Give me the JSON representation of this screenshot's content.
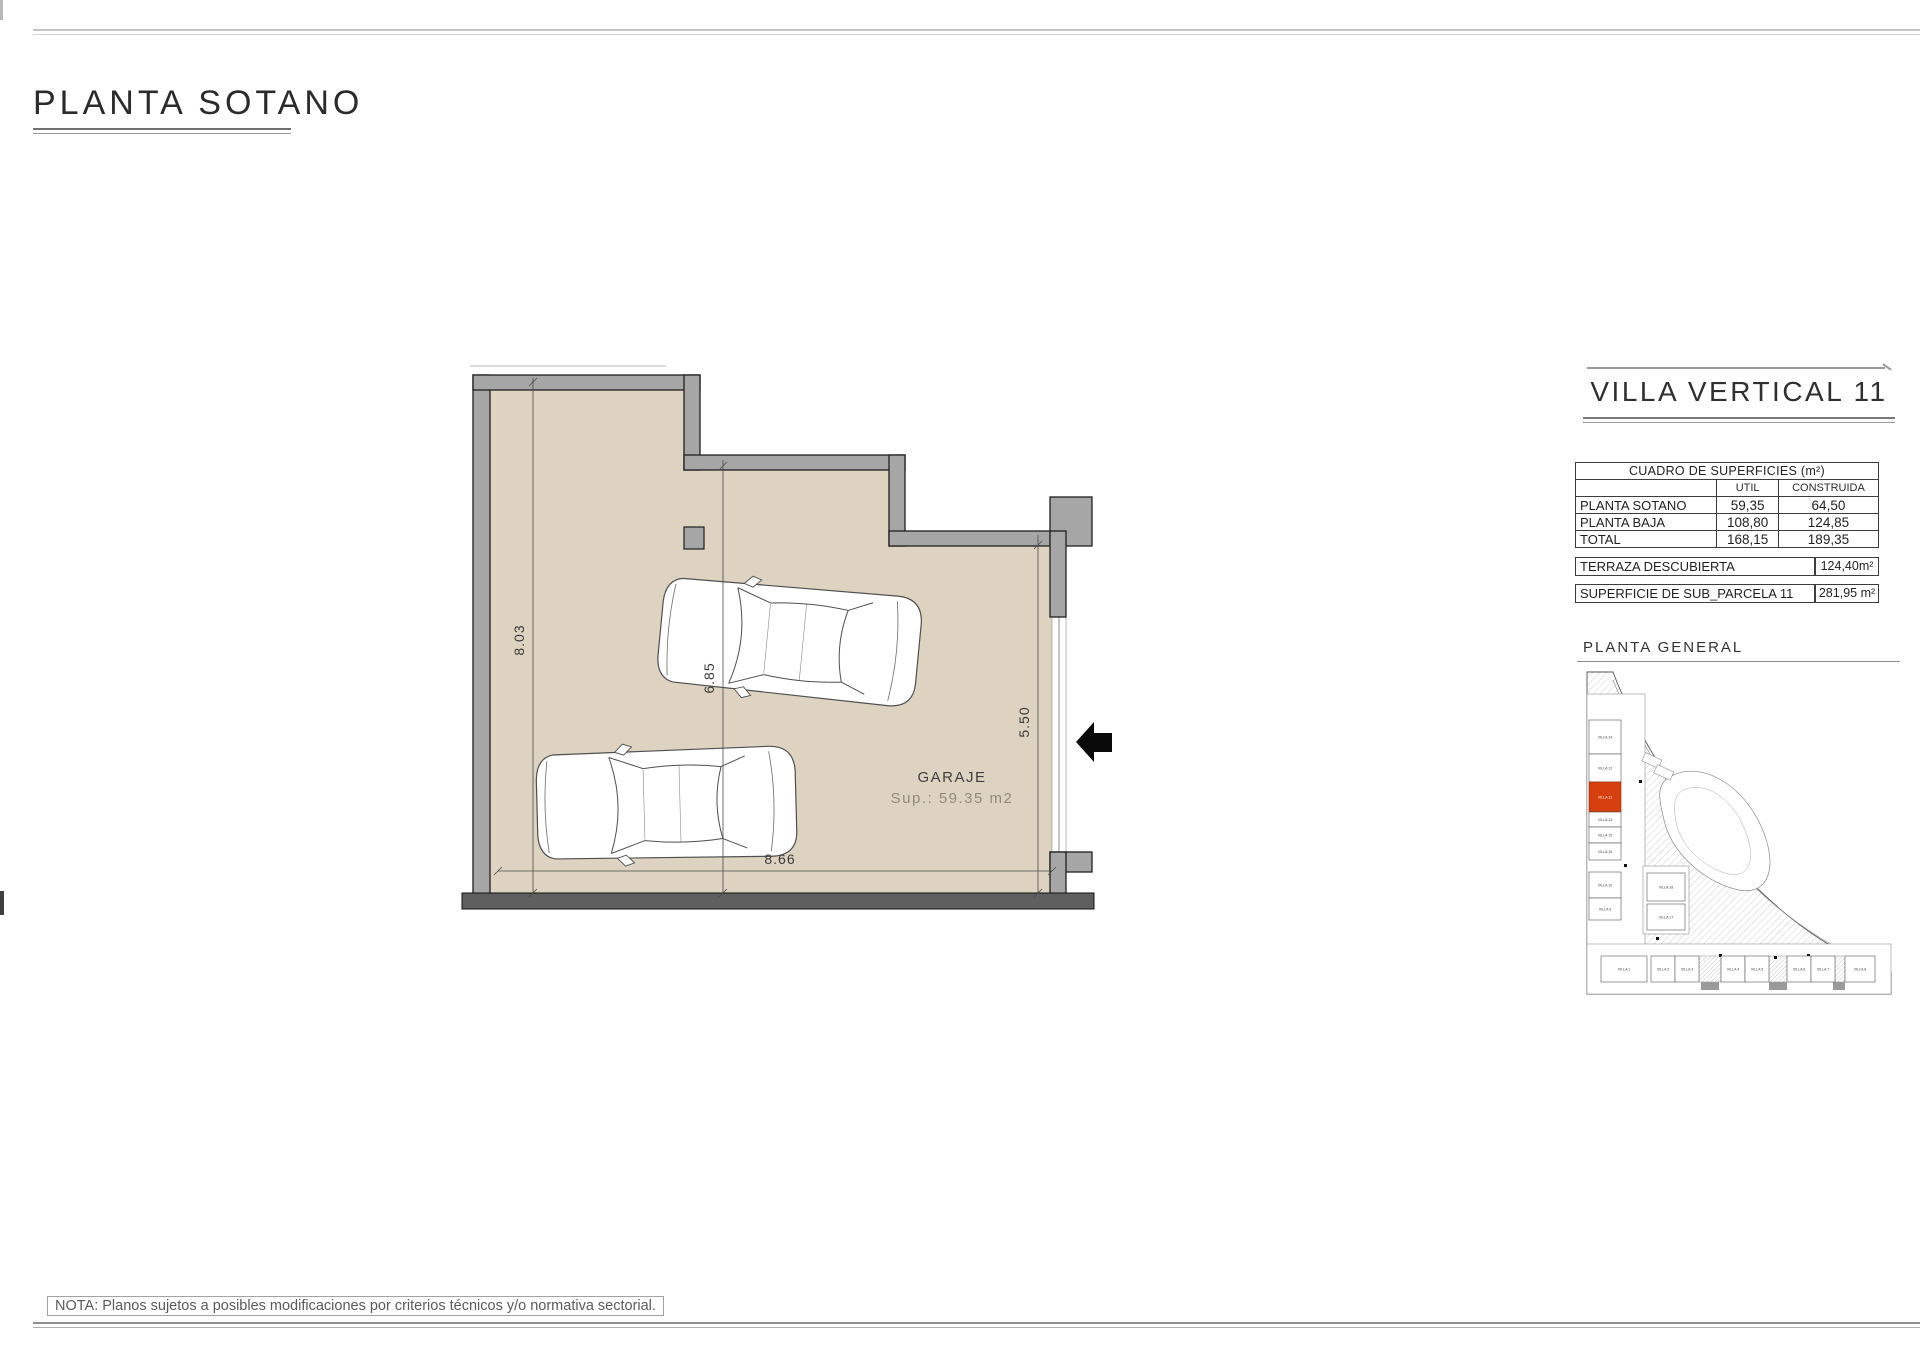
{
  "page": {
    "title": "PLANTA SOTANO",
    "note": "NOTA: Planos sujetos a posibles modificaciones por criterios técnicos y/o normativa sectorial."
  },
  "plan": {
    "labels": {
      "garage": "GARAJE",
      "area": "Sup.: 59.35 m2"
    },
    "dimensions": {
      "left": "8.03",
      "middle": "6.85",
      "right": "5.50",
      "bottom": "8.66"
    },
    "colors": {
      "floor": "#ddd3c0",
      "wall": "#a6a6a6",
      "bottom_wall": "#5f5f5f"
    }
  },
  "panel": {
    "title": "VILLA VERTICAL 11",
    "surfaces_table": {
      "title": "CUADRO DE SUPERFICIES (m²)",
      "col_util": "UTIL",
      "col_construida": "CONSTRUIDA",
      "rows": [
        {
          "label": "PLANTA SOTANO",
          "util": "59,35",
          "construida": "64,50"
        },
        {
          "label": "PLANTA BAJA",
          "util": "108,80",
          "construida": "124,85"
        },
        {
          "label": "TOTAL",
          "util": "168,15",
          "construida": "189,35"
        }
      ]
    },
    "terraza": {
      "label": "TERRAZA DESCUBIERTA",
      "value": "124,40m²"
    },
    "parcela": {
      "label": "SUPERFICIE DE SUB_PARCELA  11",
      "value": "281,95 m²"
    },
    "site_plan": {
      "title": "PLANTA  GENERAL",
      "highlighted_unit": "VILLA 11",
      "highlight_color": "#d5400e",
      "left_column": [
        "VILLA 14",
        "VILLA 12",
        "VILLA 11",
        "VILLA 13",
        "VILLA 15",
        "VILLA 16",
        "VILLA 10",
        "VILLA 9"
      ],
      "middle_column": [
        "VILLA 18",
        "VILLA 17"
      ],
      "bottom_row": [
        "VILLA 1",
        "VILLA 2",
        "VILLA 3",
        "VILLA 4",
        "VILLA 5",
        "VILLA 6",
        "VILLA 7",
        "VILLA 8"
      ]
    }
  }
}
